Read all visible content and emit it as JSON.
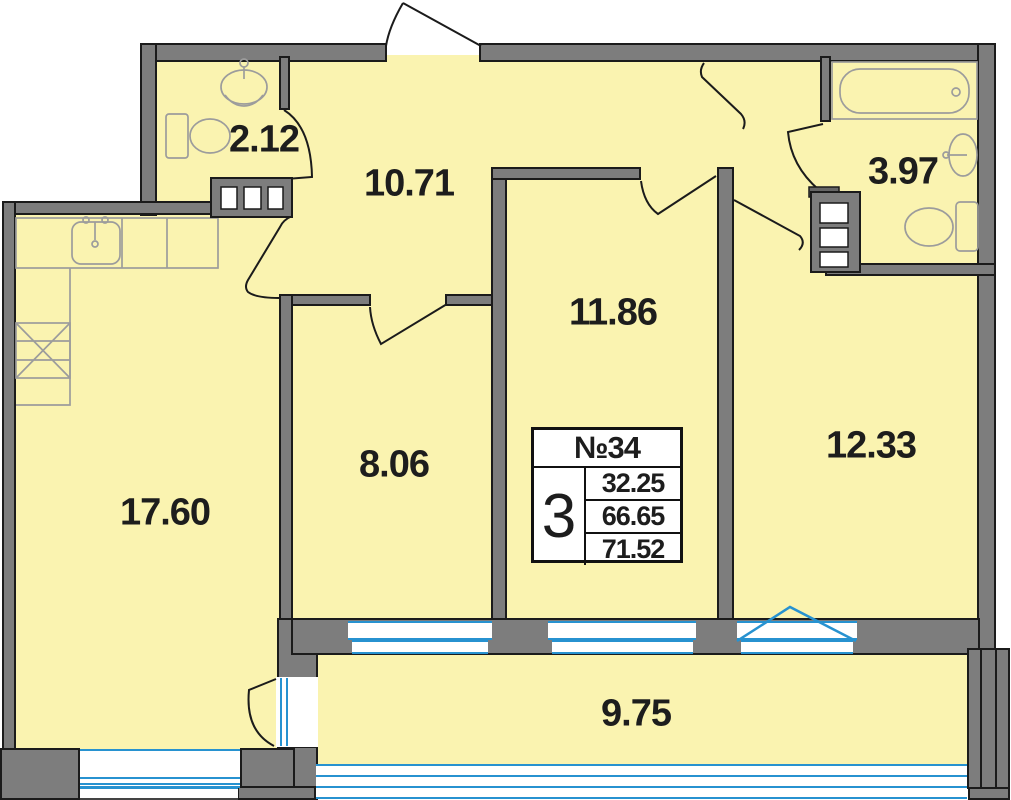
{
  "plan": {
    "title": "apartment floor plan",
    "unit_box": {
      "number": "№34",
      "room_count": "3",
      "area_living": "32.25",
      "area_usable": "66.65",
      "area_total": "71.52"
    },
    "rooms": [
      {
        "key": "wc",
        "area": "2.12"
      },
      {
        "key": "hallway",
        "area": "10.71"
      },
      {
        "key": "bathroom",
        "area": "3.97"
      },
      {
        "key": "bedroom-middle",
        "area": "11.86"
      },
      {
        "key": "room-small",
        "area": "8.06"
      },
      {
        "key": "kitchen-living",
        "area": "17.60"
      },
      {
        "key": "bedroom-right",
        "area": "12.33"
      },
      {
        "key": "balcony",
        "area": "9.75"
      }
    ],
    "colors": {
      "floor": "#FAF3B0",
      "wall": "#7D7D7D",
      "outline": "#1B1B1B",
      "fixtures": "#9C9C9C",
      "glazing_blue": "#2792D0"
    }
  }
}
